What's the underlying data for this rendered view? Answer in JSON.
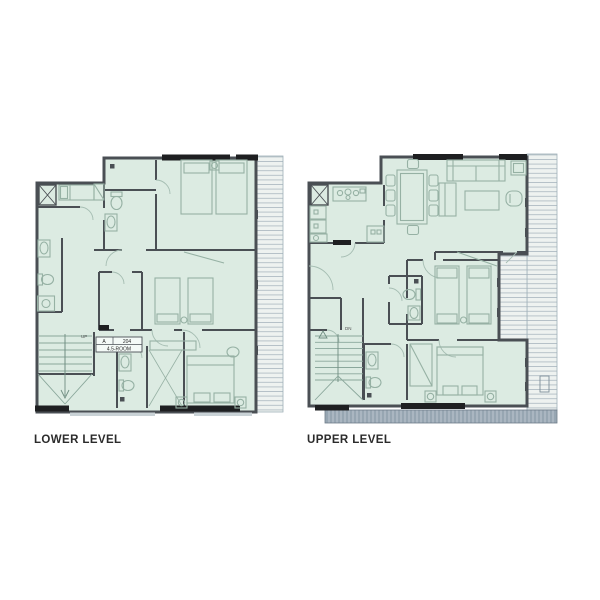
{
  "background": "#ffffff",
  "colors": {
    "room_fill": "#dcebe2",
    "wall": "#4a4f54",
    "wall_black": "#1e1f21",
    "furniture_line": "#96b1a4",
    "deck_line": "#b3bfc6",
    "walkway_fill": "#97a6b2",
    "label_text": "#2b2b2b"
  },
  "plans": {
    "lower": {
      "label": "LOWER LEVEL",
      "stair_direction": "UP",
      "unit_tag": {
        "col1": "A",
        "col2": "204",
        "row2": "4.5-ROOM"
      }
    },
    "upper": {
      "label": "UPPER LEVEL",
      "stair_direction": "DN"
    }
  }
}
